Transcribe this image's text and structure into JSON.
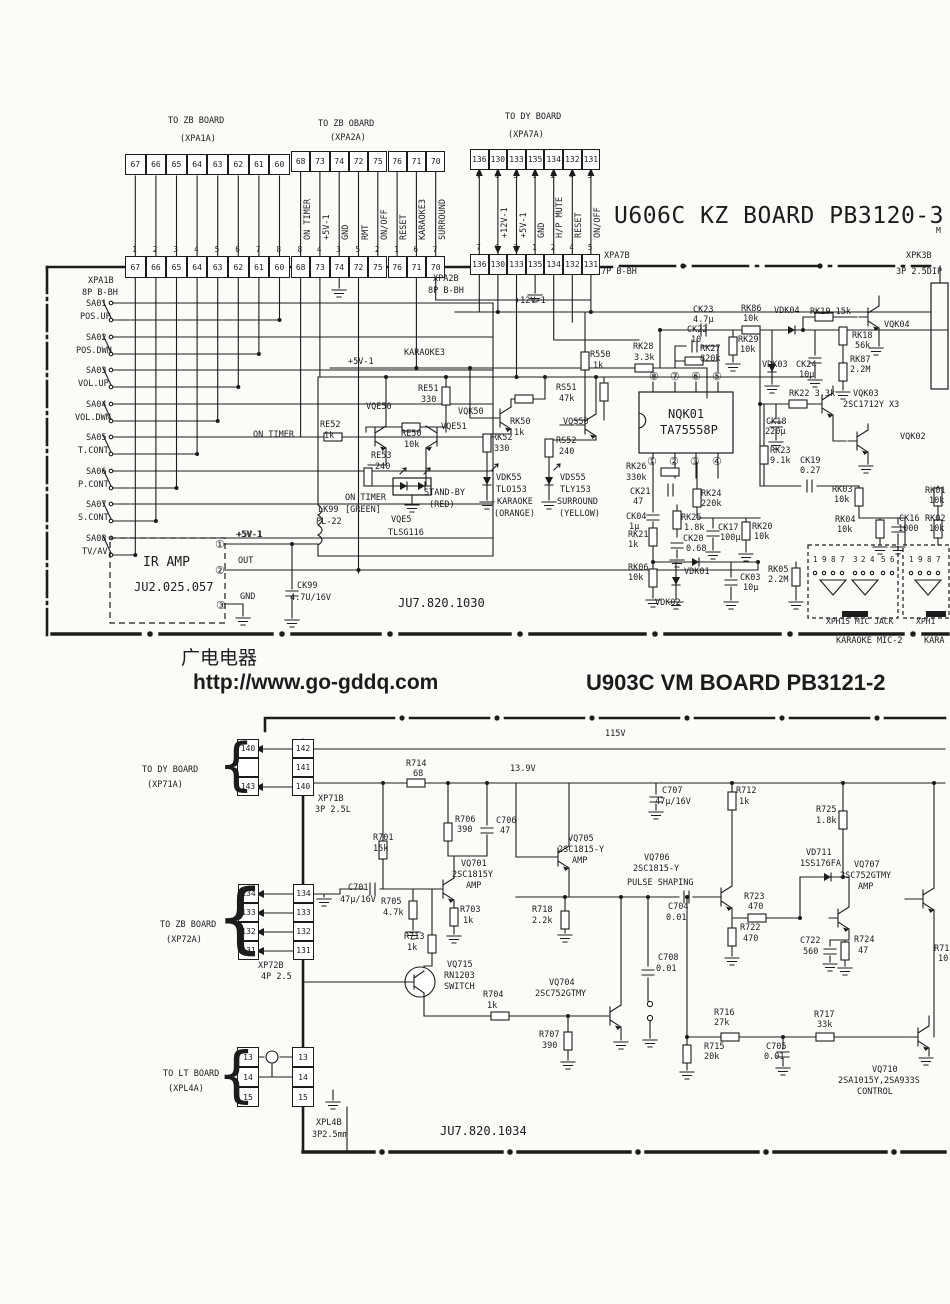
{
  "page": {
    "bg": "#fbfbf8",
    "ink": "#1c1c1c"
  },
  "board1": {
    "title": "U606C KZ BOARD PB3120-3",
    "title_suffix": "M",
    "code": "JU7.820.1030"
  },
  "board2": {
    "title": "U903C VM BOARD PB3121-2",
    "code": "JU7.820.1034"
  },
  "watermark": {
    "line1": "广电电器",
    "line2": "http://www.go-gddq.com"
  },
  "connectors": [
    {
      "x": 125,
      "y": 154,
      "w": 20.6,
      "h": 21,
      "cells": [
        "67",
        "66",
        "65",
        "64",
        "63",
        "62",
        "61",
        "60"
      ]
    },
    {
      "x": 125,
      "y": 256,
      "w": 20.6,
      "h": 22,
      "cells": [
        "67",
        "66",
        "65",
        "64",
        "63",
        "62",
        "61",
        "60"
      ],
      "pins": {
        "v": [
          "1",
          "2",
          "3",
          "4",
          "5",
          "6",
          "7",
          "8"
        ],
        "dy": -10
      }
    },
    {
      "x": 291,
      "y": 151,
      "w": 19.3,
      "h": 21,
      "cells": [
        "68",
        "73",
        "74",
        "72",
        "75",
        "76",
        "71",
        "70"
      ]
    },
    {
      "x": 291,
      "y": 256,
      "w": 19.3,
      "h": 22,
      "cells": [
        "68",
        "73",
        "74",
        "72",
        "75",
        "76",
        "71",
        "70"
      ],
      "pins": {
        "v": [
          "8",
          "4",
          "3",
          "5",
          "2",
          "1",
          "6",
          "7"
        ],
        "dy": -10
      }
    },
    {
      "x": 470,
      "y": 149,
      "w": 18.6,
      "h": 21,
      "cells": [
        "136",
        "130",
        "133",
        "135",
        "134",
        "132",
        "131"
      ],
      "pins": {
        "v": [
          "7",
          "6",
          "3",
          "1",
          "2",
          "4",
          "5"
        ],
        "dy": 23
      }
    },
    {
      "x": 470,
      "y": 254,
      "w": 18.6,
      "h": 21,
      "cells": [
        "136",
        "130",
        "133",
        "135",
        "134",
        "132",
        "131"
      ],
      "pins": {
        "v": [
          "7",
          "6",
          "3",
          "1",
          "2",
          "4",
          "5"
        ],
        "dy": -10
      }
    },
    {
      "x": 237,
      "y": 739,
      "w": 22,
      "h": 19,
      "vert": 1,
      "cells": [
        "140",
        "",
        "143"
      ]
    },
    {
      "x": 292,
      "y": 739,
      "w": 22,
      "h": 19,
      "vert": 1,
      "cells": [
        "142",
        "141",
        "140"
      ]
    },
    {
      "x": 238,
      "y": 884,
      "w": 21,
      "h": 19,
      "vert": 1,
      "cells": [
        "134",
        "133",
        "132",
        "131"
      ]
    },
    {
      "x": 293,
      "y": 884,
      "w": 21,
      "h": 19,
      "vert": 1,
      "cells": [
        "134",
        "133",
        "132",
        "131"
      ]
    },
    {
      "x": 237,
      "y": 1047,
      "w": 22,
      "h": 20,
      "vert": 1,
      "cells": [
        "13",
        "14",
        "15"
      ]
    },
    {
      "x": 292,
      "y": 1047,
      "w": 22,
      "h": 20,
      "vert": 1,
      "cells": [
        "13",
        "14",
        "15"
      ]
    }
  ],
  "labels": [
    [
      168,
      117,
      "TO ZB BOARD"
    ],
    [
      180,
      135,
      "(XPA1A)"
    ],
    [
      318,
      120,
      "TO ZB OBARD"
    ],
    [
      330,
      134,
      "(XPA2A)"
    ],
    [
      505,
      113,
      "TO DY BOARD"
    ],
    [
      508,
      131,
      "(XPA7A)"
    ],
    [
      304,
      240,
      "ON TIMER",
      8.5,
      "v"
    ],
    [
      323,
      240,
      "+5V-1",
      8.5,
      "v"
    ],
    [
      342,
      240,
      "GND",
      8.5,
      "v"
    ],
    [
      362,
      240,
      "RMT",
      8.5,
      "v"
    ],
    [
      381,
      240,
      "ON/OFF",
      8.5,
      "v"
    ],
    [
      400,
      240,
      "RESET",
      8.5,
      "v"
    ],
    [
      419,
      240,
      "KARAOKE3",
      8.5,
      "v"
    ],
    [
      439,
      240,
      "SURROUND",
      8.5,
      "v"
    ],
    [
      501,
      238,
      "+12V-1",
      8.5,
      "v"
    ],
    [
      520,
      238,
      "+5V-1",
      8.5,
      "v"
    ],
    [
      538,
      238,
      "GND",
      8.5,
      "v"
    ],
    [
      556,
      238,
      "H/P MUTE",
      8.5,
      "v"
    ],
    [
      575,
      238,
      "RESET",
      8.5,
      "v"
    ],
    [
      594,
      238,
      "ON/OFF",
      8.5,
      "v"
    ],
    [
      88,
      277,
      "XPA1B"
    ],
    [
      82,
      289,
      "8P B-BH"
    ],
    [
      433,
      275,
      "XPA2B"
    ],
    [
      428,
      287,
      "8P B-BH"
    ],
    [
      604,
      252,
      "XPA7B"
    ],
    [
      601,
      268,
      "7P B-BH"
    ],
    [
      906,
      252,
      "XPK3B"
    ],
    [
      896,
      268,
      "3P 2.5DIP"
    ],
    [
      86,
      300,
      "SA01"
    ],
    [
      80,
      313,
      "POS.UP"
    ],
    [
      86,
      334,
      "SA02"
    ],
    [
      76,
      347,
      "POS.DWN"
    ],
    [
      86,
      367,
      "SA03"
    ],
    [
      78,
      380,
      "VOL.UP"
    ],
    [
      86,
      401,
      "SA04"
    ],
    [
      75,
      414,
      "VOL.DWN"
    ],
    [
      86,
      434,
      "SA05"
    ],
    [
      78,
      447,
      "T.CONT"
    ],
    [
      86,
      468,
      "SA06"
    ],
    [
      78,
      481,
      "P.CONT"
    ],
    [
      86,
      501,
      "SA07"
    ],
    [
      78,
      514,
      "S.CONT"
    ],
    [
      86,
      535,
      "SA08"
    ],
    [
      82,
      548,
      "TV/AV"
    ],
    [
      253,
      431,
      "ON TIMER"
    ],
    [
      236,
      531,
      "+5V-1"
    ],
    [
      348,
      358,
      "+5V-1"
    ],
    [
      404,
      349,
      "KARAOKE3"
    ],
    [
      515,
      297,
      "+12V-1"
    ],
    [
      320,
      421,
      "RE52"
    ],
    [
      324,
      432,
      "1k"
    ],
    [
      366,
      403,
      "VQE50"
    ],
    [
      401,
      430,
      "RE50"
    ],
    [
      404,
      441,
      "10k"
    ],
    [
      418,
      385,
      "RE51"
    ],
    [
      421,
      396,
      "330"
    ],
    [
      441,
      423,
      "VQE51"
    ],
    [
      371,
      452,
      "RE53"
    ],
    [
      375,
      463,
      "240"
    ],
    [
      345,
      494,
      "ON TIMER"
    ],
    [
      345,
      506,
      "[GREEN]"
    ],
    [
      424,
      489,
      "STAND-BY"
    ],
    [
      429,
      501,
      "(RED)"
    ],
    [
      391,
      516,
      "VQE5"
    ],
    [
      388,
      529,
      "TLSG116"
    ],
    [
      458,
      408,
      "VQK50"
    ],
    [
      510,
      418,
      "RK50"
    ],
    [
      514,
      429,
      "1k"
    ],
    [
      492,
      434,
      "RK52"
    ],
    [
      494,
      445,
      "330"
    ],
    [
      496,
      474,
      "VDK55"
    ],
    [
      496,
      486,
      "TLO153"
    ],
    [
      497,
      498,
      "KARAOKE"
    ],
    [
      494,
      510,
      "(ORANGE)"
    ],
    [
      563,
      418,
      "VQS50"
    ],
    [
      556,
      384,
      "RS51"
    ],
    [
      559,
      395,
      "47k"
    ],
    [
      556,
      437,
      "RS52"
    ],
    [
      559,
      448,
      "240"
    ],
    [
      560,
      474,
      "VDS55"
    ],
    [
      560,
      486,
      "TLY153"
    ],
    [
      557,
      498,
      "SURROUND"
    ],
    [
      559,
      510,
      "(YELLOW)"
    ],
    [
      318,
      506,
      "LK99"
    ],
    [
      316,
      518,
      "PL-22"
    ],
    [
      590,
      351,
      "R550"
    ],
    [
      593,
      362,
      "1k"
    ],
    [
      633,
      343,
      "RK28"
    ],
    [
      634,
      354,
      "3.3k"
    ],
    [
      693,
      306,
      "CK23"
    ],
    [
      693,
      316,
      "4.7μ"
    ],
    [
      687,
      326,
      "CK22"
    ],
    [
      691,
      336,
      "10"
    ],
    [
      700,
      345,
      "RK27"
    ],
    [
      700,
      355,
      "820k"
    ],
    [
      741,
      305,
      "RK86"
    ],
    [
      743,
      315,
      "10k"
    ],
    [
      738,
      336,
      "RK29"
    ],
    [
      740,
      346,
      "10k"
    ],
    [
      774,
      307,
      "VDK04"
    ],
    [
      810,
      308,
      "RK19 15k"
    ],
    [
      852,
      332,
      "RK18"
    ],
    [
      855,
      342,
      "56k"
    ],
    [
      850,
      356,
      "RK87"
    ],
    [
      850,
      366,
      "2.2M"
    ],
    [
      884,
      321,
      "VQK04"
    ],
    [
      762,
      361,
      "VDK03"
    ],
    [
      796,
      361,
      "CK24"
    ],
    [
      799,
      371,
      "10μ"
    ],
    [
      789,
      390,
      "RK22 3.3k"
    ],
    [
      766,
      418,
      "CK18"
    ],
    [
      765,
      428,
      "220μ"
    ],
    [
      853,
      390,
      "VQK03"
    ],
    [
      843,
      401,
      "2SC1712Y X3"
    ],
    [
      900,
      433,
      "VQK02"
    ],
    [
      770,
      447,
      "RK23"
    ],
    [
      770,
      457,
      "9.1k"
    ],
    [
      800,
      457,
      "CK19"
    ],
    [
      800,
      467,
      "0.27"
    ],
    [
      626,
      463,
      "RK26"
    ],
    [
      626,
      474,
      "330k"
    ],
    [
      630,
      488,
      "CK21"
    ],
    [
      633,
      498,
      "47"
    ],
    [
      701,
      490,
      "RK24"
    ],
    [
      701,
      500,
      "220k"
    ],
    [
      626,
      513,
      "CK04"
    ],
    [
      629,
      523,
      "1μ"
    ],
    [
      681,
      514,
      "RK25"
    ],
    [
      684,
      524,
      "1.8k"
    ],
    [
      683,
      535,
      "CK20"
    ],
    [
      686,
      545,
      "0.68"
    ],
    [
      718,
      524,
      "CK17"
    ],
    [
      720,
      534,
      "100μ"
    ],
    [
      752,
      523,
      "RK20"
    ],
    [
      754,
      533,
      "10k"
    ],
    [
      628,
      531,
      "RK21"
    ],
    [
      628,
      541,
      "1k"
    ],
    [
      628,
      564,
      "RK06"
    ],
    [
      628,
      574,
      "10k"
    ],
    [
      684,
      568,
      "VDK01"
    ],
    [
      655,
      599,
      "VDK02"
    ],
    [
      740,
      574,
      "CK03"
    ],
    [
      743,
      584,
      "10μ"
    ],
    [
      768,
      566,
      "RK05"
    ],
    [
      768,
      576,
      "2.2M"
    ],
    [
      832,
      486,
      "RK03"
    ],
    [
      834,
      496,
      "10k"
    ],
    [
      835,
      516,
      "RK04"
    ],
    [
      837,
      526,
      "10k"
    ],
    [
      899,
      515,
      "CK16"
    ],
    [
      898,
      525,
      "1000"
    ],
    [
      925,
      487,
      "RK01"
    ],
    [
      929,
      497,
      "10k"
    ],
    [
      925,
      515,
      "RK02"
    ],
    [
      929,
      525,
      "10k"
    ],
    [
      668,
      408,
      "NQK01",
      12
    ],
    [
      660,
      424,
      "TA75558P",
      12
    ],
    [
      649,
      371,
      "⑧",
      11
    ],
    [
      670,
      371,
      "⑦",
      11
    ],
    [
      691,
      371,
      "⑥",
      11
    ],
    [
      712,
      371,
      "⑤",
      11
    ],
    [
      647,
      456,
      "①",
      11
    ],
    [
      669,
      456,
      "②",
      11
    ],
    [
      690,
      456,
      "③",
      11
    ],
    [
      712,
      456,
      "④",
      11
    ],
    [
      143,
      556,
      "IR AMP",
      13
    ],
    [
      134,
      581,
      "JU2.025.057",
      12
    ],
    [
      237,
      531,
      "+5V-1"
    ],
    [
      238,
      557,
      "OUT"
    ],
    [
      240,
      593,
      "GND"
    ],
    [
      215,
      539,
      "①",
      11
    ],
    [
      215,
      565,
      "②",
      11
    ],
    [
      216,
      600,
      "③",
      11
    ],
    [
      297,
      582,
      "CK99"
    ],
    [
      290,
      594,
      "4.7U/16V"
    ],
    [
      398,
      597,
      "JU7.820.1030",
      12
    ],
    [
      813,
      556,
      "1",
      7.5
    ],
    [
      822,
      556,
      "9",
      7.5
    ],
    [
      831,
      556,
      "8",
      7.5
    ],
    [
      840,
      556,
      "7",
      7.5
    ],
    [
      853,
      556,
      "3",
      7.5
    ],
    [
      861,
      556,
      "2",
      7.5
    ],
    [
      870,
      556,
      "4",
      7.5
    ],
    [
      881,
      556,
      "5",
      7.5
    ],
    [
      890,
      556,
      "6",
      7.5
    ],
    [
      909,
      556,
      "1",
      7.5
    ],
    [
      918,
      556,
      "9",
      7.5
    ],
    [
      927,
      556,
      "8",
      7.5
    ],
    [
      936,
      556,
      "7",
      7.5
    ],
    [
      826,
      618,
      "XPH15 MIC JACK",
      8
    ],
    [
      836,
      637,
      "KARAOKE MIC-2",
      8.5
    ],
    [
      916,
      618,
      "XPH1",
      8
    ],
    [
      924,
      637,
      "KARA",
      8.5
    ],
    [
      142,
      766,
      "TO DY BOARD"
    ],
    [
      147,
      781,
      "(XP71A)"
    ],
    [
      160,
      921,
      "TO ZB BOARD"
    ],
    [
      166,
      936,
      "(XP72A)"
    ],
    [
      163,
      1070,
      "TO LT BOARD"
    ],
    [
      168,
      1085,
      "(XPL4A)"
    ],
    [
      318,
      795,
      "XP71B"
    ],
    [
      315,
      806,
      "3P 2.5L"
    ],
    [
      258,
      962,
      "XP72B"
    ],
    [
      261,
      973,
      "4P 2.5"
    ],
    [
      316,
      1119,
      "XPL4B"
    ],
    [
      312,
      1131,
      "3P2.5mm"
    ],
    [
      440,
      1125,
      "JU7.820.1034",
      12
    ],
    [
      605,
      730,
      "115V"
    ],
    [
      510,
      765,
      "13.9V"
    ],
    [
      406,
      760,
      "R714"
    ],
    [
      413,
      770,
      "68"
    ],
    [
      455,
      816,
      "R706"
    ],
    [
      457,
      826,
      "390"
    ],
    [
      496,
      817,
      "C706"
    ],
    [
      500,
      827,
      "47"
    ],
    [
      373,
      834,
      "R701"
    ],
    [
      373,
      845,
      "15k"
    ],
    [
      348,
      884,
      "C701"
    ],
    [
      340,
      896,
      "47μ/16V"
    ],
    [
      381,
      898,
      "R705"
    ],
    [
      383,
      909,
      "4.7k"
    ],
    [
      461,
      860,
      "VQ701"
    ],
    [
      452,
      871,
      "2SC1815Y"
    ],
    [
      466,
      882,
      "AMP"
    ],
    [
      460,
      906,
      "R703"
    ],
    [
      463,
      917,
      "1k"
    ],
    [
      404,
      933,
      "R713"
    ],
    [
      407,
      944,
      "1k"
    ],
    [
      447,
      961,
      "VQ715"
    ],
    [
      444,
      972,
      "RN1203"
    ],
    [
      444,
      983,
      "SWITCH"
    ],
    [
      483,
      991,
      "R704"
    ],
    [
      487,
      1002,
      "1k"
    ],
    [
      549,
      979,
      "VQ704"
    ],
    [
      535,
      990,
      "2SC752GTMY"
    ],
    [
      539,
      1031,
      "R707"
    ],
    [
      542,
      1042,
      "390"
    ],
    [
      532,
      906,
      "R718"
    ],
    [
      532,
      917,
      "2.2k"
    ],
    [
      568,
      835,
      "VQ705"
    ],
    [
      558,
      846,
      "2SC1815-Y"
    ],
    [
      572,
      857,
      "AMP"
    ],
    [
      644,
      854,
      "VQ706"
    ],
    [
      633,
      865,
      "2SC1815-Y"
    ],
    [
      627,
      879,
      "PULSE SHAPING"
    ],
    [
      668,
      903,
      "C704"
    ],
    [
      666,
      914,
      "0.01"
    ],
    [
      662,
      787,
      "C707"
    ],
    [
      655,
      798,
      "47μ/16V"
    ],
    [
      736,
      787,
      "R712"
    ],
    [
      739,
      798,
      "1k"
    ],
    [
      744,
      893,
      "R723"
    ],
    [
      748,
      903,
      "470"
    ],
    [
      740,
      924,
      "R722"
    ],
    [
      743,
      935,
      "470"
    ],
    [
      816,
      806,
      "R725"
    ],
    [
      816,
      817,
      "1.8k"
    ],
    [
      806,
      849,
      "VD711"
    ],
    [
      800,
      860,
      "1SS176FA"
    ],
    [
      854,
      861,
      "VQ707"
    ],
    [
      840,
      872,
      "2SC752GTMY"
    ],
    [
      858,
      883,
      "AMP"
    ],
    [
      800,
      937,
      "C722"
    ],
    [
      803,
      948,
      "560"
    ],
    [
      854,
      936,
      "R724"
    ],
    [
      858,
      947,
      "47"
    ],
    [
      658,
      954,
      "C708"
    ],
    [
      656,
      965,
      "0.01"
    ],
    [
      714,
      1009,
      "R716"
    ],
    [
      714,
      1019,
      "27k"
    ],
    [
      814,
      1011,
      "R717"
    ],
    [
      817,
      1021,
      "33k"
    ],
    [
      704,
      1043,
      "R715"
    ],
    [
      704,
      1053,
      "20k"
    ],
    [
      766,
      1043,
      "C705"
    ],
    [
      764,
      1053,
      "0.01"
    ],
    [
      872,
      1066,
      "VQ710"
    ],
    [
      838,
      1077,
      "2SA1015Y,2SA933S"
    ],
    [
      857,
      1088,
      "CONTROL"
    ],
    [
      934,
      945,
      "R71"
    ],
    [
      938,
      955,
      "10"
    ],
    [
      219,
      736,
      "{",
      57
    ],
    [
      217,
      879,
      "{",
      77
    ],
    [
      218,
      1043,
      "{",
      61
    ]
  ]
}
